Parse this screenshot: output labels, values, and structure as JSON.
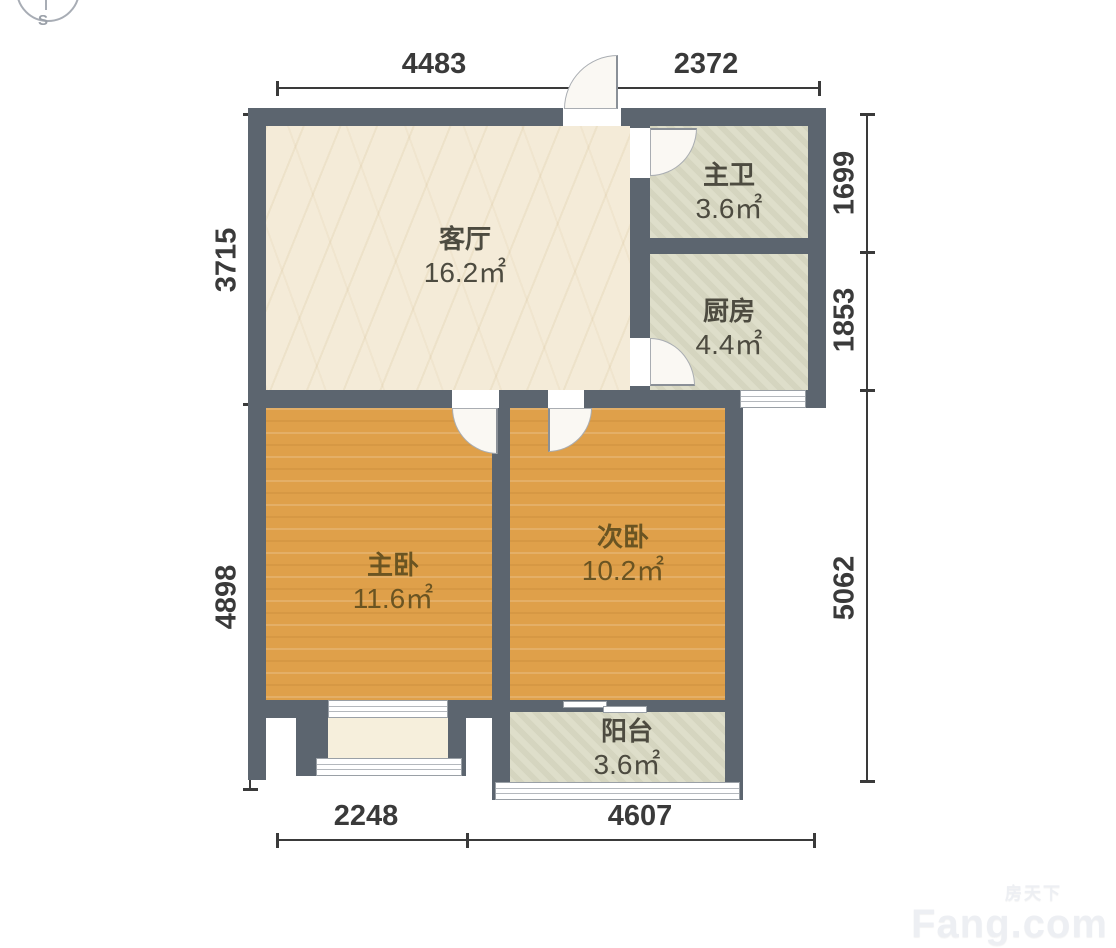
{
  "colors": {
    "wall": "#5c656f",
    "wood": "#dfa04a",
    "tile": "#dadac4",
    "cream": "#f4ebd8",
    "bay": "#f6efdc",
    "dim": "#3a3a3a",
    "label": "#4d4b40",
    "wood_label": "#6a5422",
    "wm": "#edeff3"
  },
  "compass": {
    "south": "S"
  },
  "rooms": {
    "living": {
      "name": "客厅",
      "area": "16.2㎡"
    },
    "master_bath": {
      "name": "主卫",
      "area": "3.6㎡"
    },
    "kitchen": {
      "name": "厨房",
      "area": "4.4㎡"
    },
    "master_bedroom": {
      "name": "主卧",
      "area": "11.6㎡"
    },
    "second_bedroom": {
      "name": "次卧",
      "area": "10.2㎡"
    },
    "balcony": {
      "name": "阳台",
      "area": "3.6㎡"
    }
  },
  "dims": {
    "top": [
      "4483",
      "2372"
    ],
    "bottom": [
      "2248",
      "4607"
    ],
    "left": [
      "3715",
      "4898"
    ],
    "right": [
      "1699",
      "1853",
      "5062"
    ]
  },
  "watermark": {
    "cn": "房天下",
    "en": "Fang.com"
  }
}
